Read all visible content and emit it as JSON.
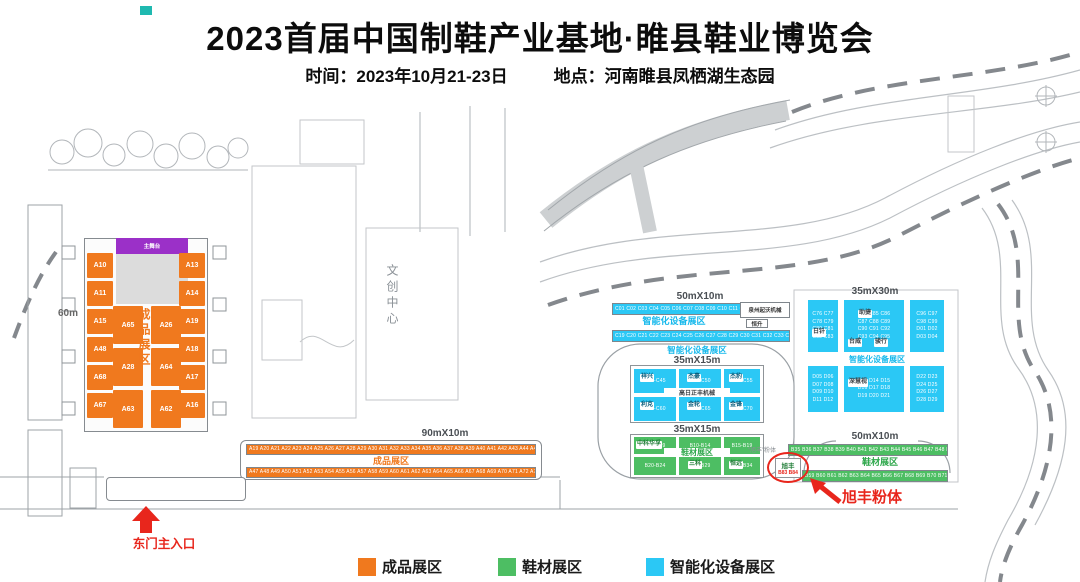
{
  "header": {
    "title": "2023首届中国制鞋产业基地·睢县鞋业博览会",
    "time_label": "时间：2023年10月21-23日",
    "place_label": "地点：河南睢县凤栖湖生态园"
  },
  "colors": {
    "finished_orange": "#F0791E",
    "material_green": "#4DBE63",
    "smart_cyan": "#2BC8F5",
    "stage_purple": "#9B30C8",
    "annotation_red": "#E8261C"
  },
  "legend": {
    "finished": "成品展区",
    "material": "鞋材展区",
    "smart": "智能化设备展区"
  },
  "map": {
    "center_building": "文创中心",
    "east_gate_label": "东门主入口",
    "left_hall": {
      "width_label": "60m",
      "stage_label": "主舞台",
      "zone_name": "成品展区",
      "left_booths": [
        "A10",
        "A11",
        "A15",
        "A48",
        "A68",
        "A67"
      ],
      "right_booths": [
        "A13",
        "A14",
        "A19",
        "A18",
        "A17",
        "A16"
      ],
      "mid_col1": [
        "A65",
        "A28",
        "A63"
      ],
      "mid_col2": [
        "A26",
        "A64",
        "A62"
      ]
    },
    "south_strip": {
      "dims": "90mX10m",
      "zone_name": "成品展区",
      "row1": "A19 A20 A21 A22 A23 A24 A25 A26 A27 A28 A29 A30 A31 A32 A33 A34 A35 A36 A37 A38 A39 A40 A41 A42 A43 A44 A45 A46",
      "row2": "A47 A48 A49 A50 A51 A52 A53 A54 A55 A56 A57 A58 A59 A60 A61 A62 A63 A64 A65 A66 A67 A68 A69 A70 A71 A72 A73 A74"
    },
    "smart_strip": {
      "dims": "50mX10m",
      "zone_name": "智能化设备展区",
      "row1": "C01 C02 C03 C04 C05 C06 C07 C08 C09 C10 C11 C12 C13 C14 C15 C16 C17 C18",
      "row2": "C19 C20 C21 C22 C23 C24 C25 C26 C27 C28 C29 C30 C31 C32 C33 C34 C35 C36",
      "company_box": "泉州起沃机械",
      "company_chip": "恒升"
    },
    "mid_pavilion": {
      "zone_name": "智能化设备展区",
      "zone_a": {
        "dims": "35mX15m",
        "company": "高日正丰机械",
        "chips_row1": [
          "祥兴",
          "杰豪",
          "杰豹"
        ],
        "chips_row2": [
          "利克",
          "金轮",
          "金锋"
        ],
        "codes_row1": [
          "C41-C45",
          "C46-C50",
          "C51-C55"
        ],
        "codes_row2": [
          "C56-C60",
          "C61-C65",
          "C66-C70"
        ]
      },
      "zone_b": {
        "dims": "35mX15m",
        "zone_name": "鞋材展区",
        "chip_top_left": "中科华孚",
        "chip_bottom_mid": "三科",
        "chip_bottom_right": "恒远",
        "codes_row1": [
          "B05-B09",
          "B10-B14",
          "B15-B19"
        ],
        "codes_row2": [
          "B20-B24",
          "B25-B29",
          "B30-B34"
        ]
      }
    },
    "right_block": {
      "dims": "35mX30m",
      "zone_name": "智能化设备展区",
      "chip_top": "助捷",
      "chip_left": "日钎",
      "chip_mid1": "台威",
      "chip_mid2": "骏行",
      "chip_lower": "深慧视",
      "codes": {
        "u1": "C76 C77\nC78 C79\nC80 C81\nC82 C83",
        "u2": "C84 C85 C86\nC87 C88 C89\nC90 C91 C92\nC93 C94 C95",
        "u3": "C96 C97\nC98 C99\nD01 D02\nD03 D04",
        "l1": "D05 D06\nD07 D08\nD09 D10\nD11 D12",
        "l2": "D13 D14 D15\nD16 D17 D18\nD19 D20 D21",
        "l3": "D22 D23\nD24 D25\nD26 D27\nD28 D29"
      }
    },
    "material_strip": {
      "dims": "50mX10m",
      "zone_name": "鞋材展区",
      "row1": "B35 B36 B37 B38 B39 B40 B41 B42 B43 B44 B45 B46 B47 B48 B49 B50 B51 B52 B53 B54 B55 B56 B57 B58",
      "row2": "B59 B60 B61 B62 B63 B64 B65 B66 B67 B68 B69 B70 B71 B72 B73 B74 B75 B76 B77 B78 B79 B80 B81 B82",
      "xufeng_booth": "旭丰",
      "xufeng_codes": "B83 B84",
      "xufeng_note": "“旭丰”粉体",
      "xufeng_annotation": "旭丰粉体"
    }
  }
}
